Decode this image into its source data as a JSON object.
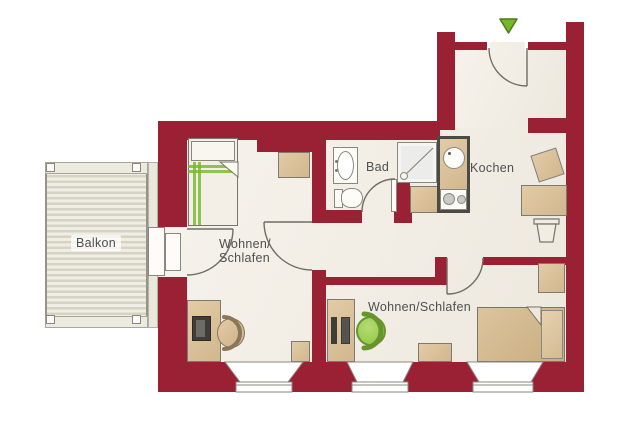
{
  "labels": {
    "balcony": "Balkon",
    "room_left_line1": "Wohnen/",
    "room_left_line2": "Schlafen",
    "bath": "Bad",
    "kitchen": "Kochen",
    "room_right": "Wohnen/Schlafen"
  },
  "colors": {
    "wall": "#9a2134",
    "floor": "#f2ede3",
    "furniture": "#d2b78e",
    "green": "#76b82a",
    "deck_stripe": "#d6d2c4"
  }
}
